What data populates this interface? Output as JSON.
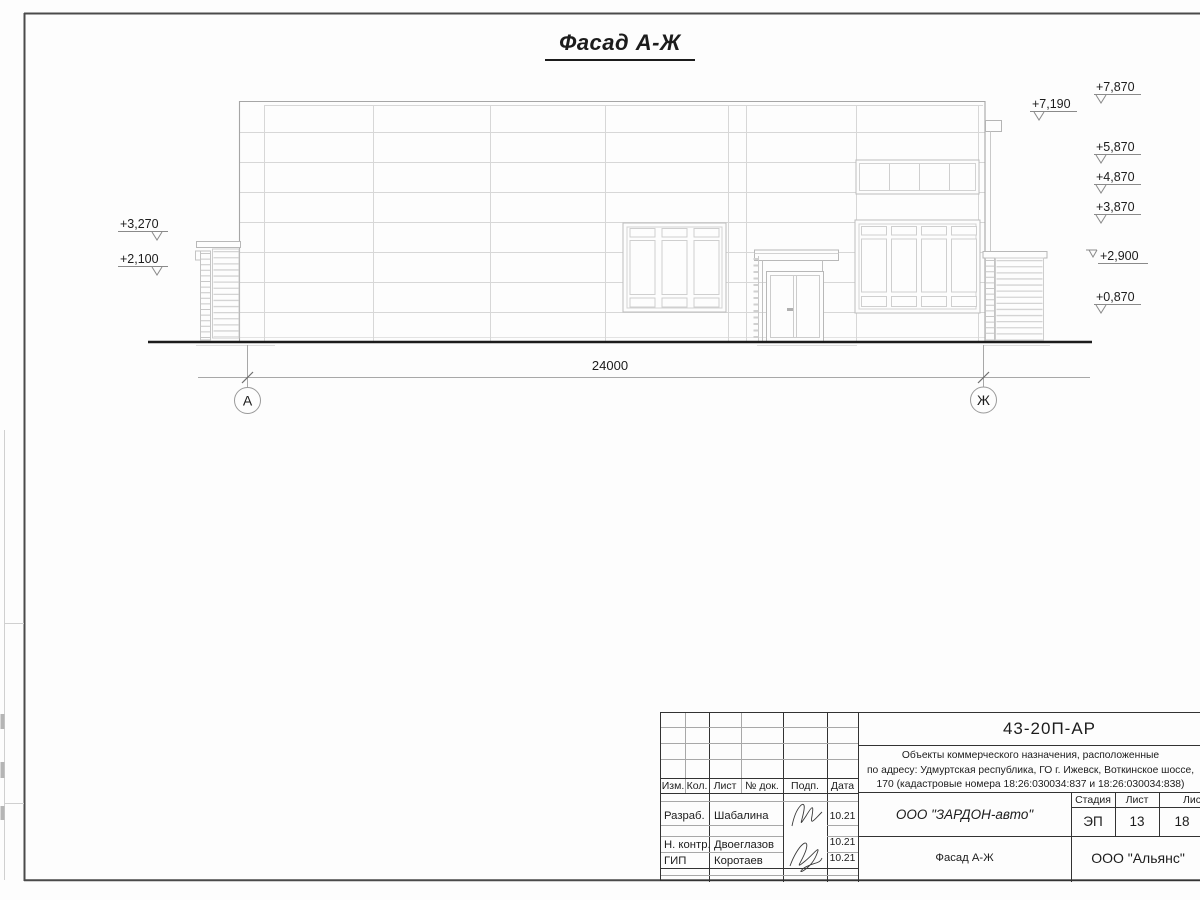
{
  "sheet": {
    "title": "Фасад А-Ж"
  },
  "drawing": {
    "dim_label": "24000",
    "axis_left": "А",
    "axis_right": "Ж",
    "elev_left": [
      "+3,270",
      "+2,100"
    ],
    "elev_right": [
      "+7,870",
      "+7,190",
      "+5,870",
      "+4,870",
      "+3,870",
      "+2,900",
      "+0,870"
    ]
  },
  "titleblock": {
    "doc_number": "43-20П-АР",
    "description": [
      "Объекты коммерческого назначения, расположенные",
      "по адресу: Удмуртская республика, ГО г. Ижевск, Воткинское шоссе,",
      "170 (кадастровые номера 18:26:030034:837 и 18:26:030034:838)"
    ],
    "columns": {
      "izm": "Изм.",
      "kol": "Кол.",
      "list": "Лист",
      "doc": "№ док.",
      "podp": "Подп.",
      "data": "Дата"
    },
    "rows": [
      {
        "role": "Разраб.",
        "name": "Шабалина",
        "date": "10.21"
      },
      {
        "role": "Н. контр.",
        "name": "Двоеглазов",
        "date": "10.21"
      },
      {
        "role": "ГИП",
        "name": "Коротаев",
        "date": "10.21"
      }
    ],
    "company": "ООО \"ЗАРДОН-авто\"",
    "sheet_title": "Фасад А-Ж",
    "stage_label": "Стадия",
    "sheet_label": "Лист",
    "sheets_label": "Листов",
    "stage": "ЭП",
    "sheet": "13",
    "sheets": "18",
    "org": "ООО \"Альянс\""
  },
  "colors": {
    "ink": "#1c1c1c",
    "frame": "#4a4a4a",
    "facade_line": "#d7d7d7"
  }
}
